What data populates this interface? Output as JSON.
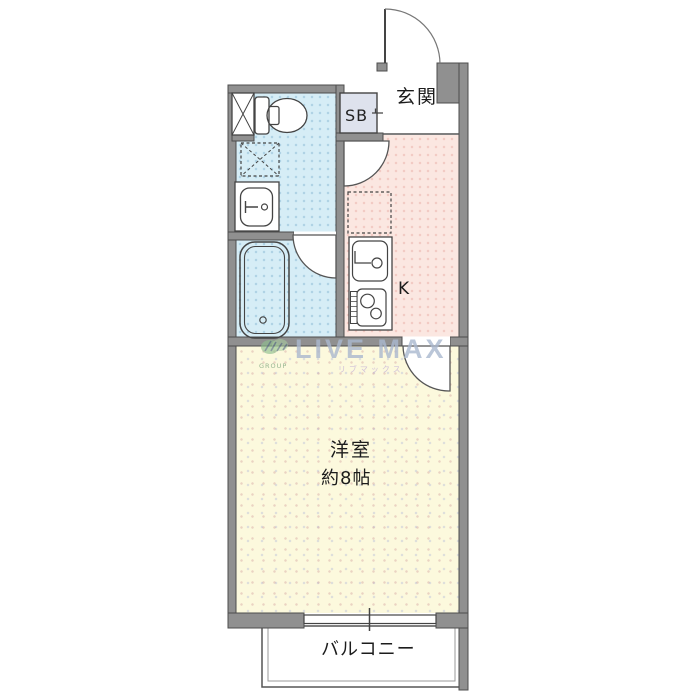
{
  "floorplan": {
    "type": "apartment-1K-floor-plan",
    "labels": {
      "genkan": "玄関",
      "shoe_box": "SB",
      "kitchen": "K",
      "main_room_name": "洋室",
      "main_room_size": "約8帖",
      "balcony": "バルコニー"
    },
    "watermark": {
      "brand": "LIVE MAX",
      "brand_kana": "リブマックス",
      "logo_caption": "GROUP"
    },
    "colors": {
      "wall": "#909090",
      "wall_outline": "#4d4d4d",
      "wet_area_fill": "#d6edf6",
      "kitchen_fill": "#fbe7e1",
      "main_room_fill": "#fcf9dd",
      "shoe_box_fill": "#dee2ed",
      "watermark_blue": "#aab8cf"
    },
    "fixtures": [
      "entrance-door",
      "pipe-shaft",
      "toilet",
      "shoe-box",
      "washing-machine-pan",
      "wash-basin",
      "bathtub",
      "bathroom-door",
      "kitchen-door",
      "refrigerator-space",
      "kitchen-sink",
      "gas-stove",
      "room-door",
      "sliding-window",
      "balcony"
    ]
  }
}
